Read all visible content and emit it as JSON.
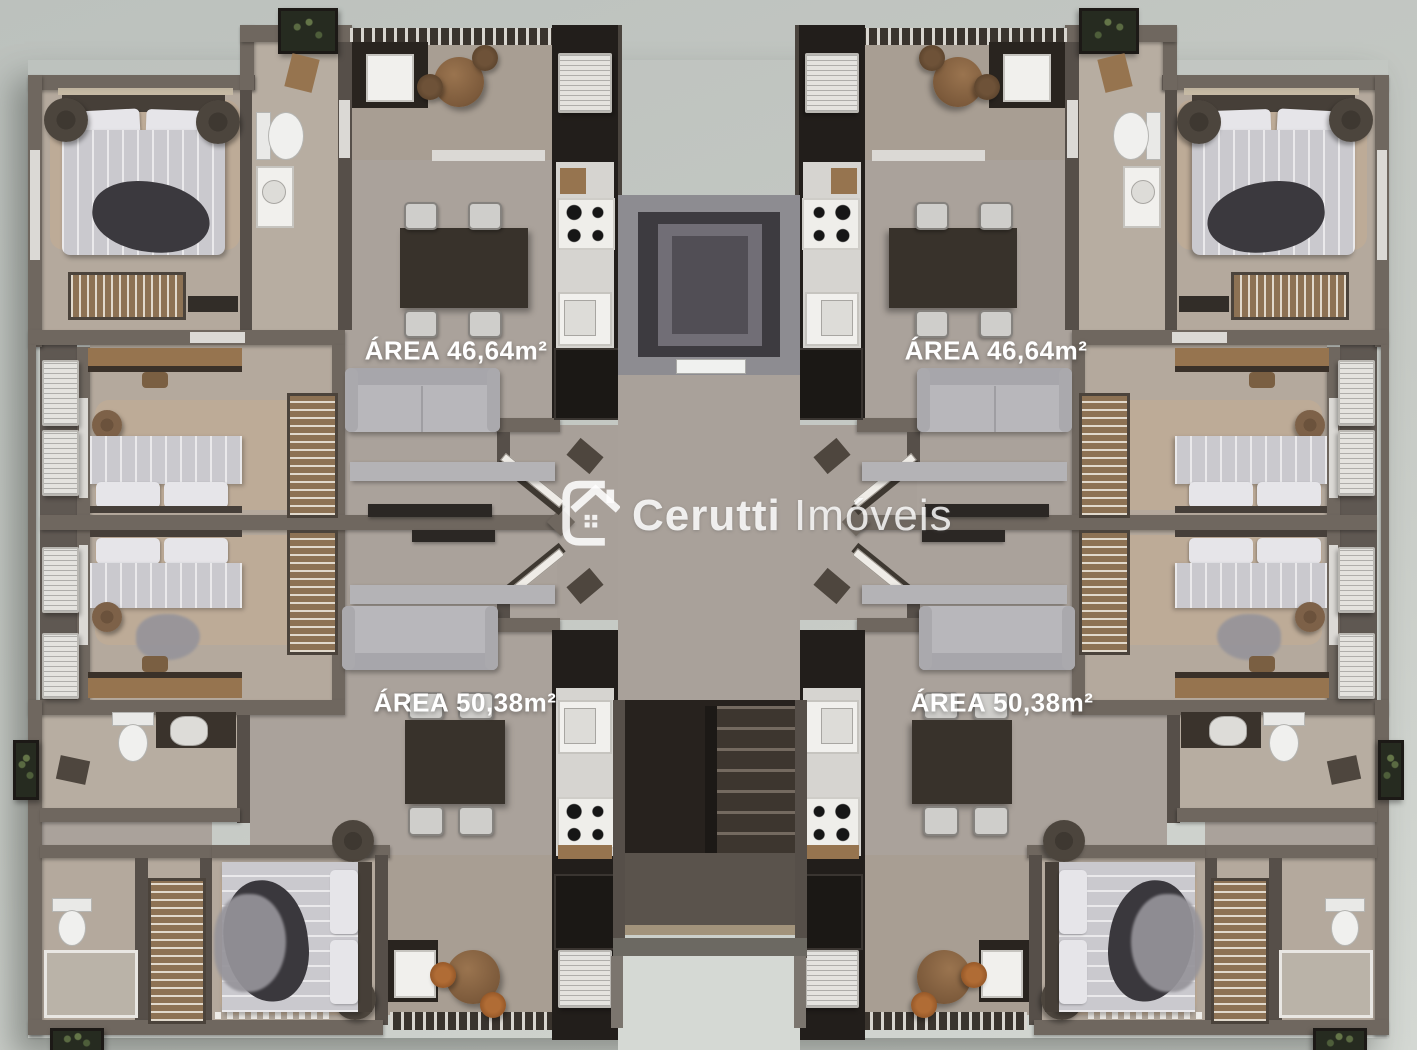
{
  "units": {
    "top_left": {
      "area_label": "ÁREA 46,64m²"
    },
    "top_right": {
      "area_label": "ÁREA 46,64m²"
    },
    "bottom_left": {
      "area_label": "ÁREA 50,38m²"
    },
    "bottom_right": {
      "area_label": "ÁREA 50,38m²"
    }
  },
  "watermark": {
    "brand": "Cerutti",
    "suffix": "Imóveis",
    "logo_icon": "house-in-c-logo"
  },
  "palette": {
    "background": "#c6cac5",
    "wall": "#6f675f",
    "wall_dark": "#564f49",
    "floor": "#a9a19a",
    "floor_bedroom": "#b4a99d",
    "floor_balcony": "#a89e93",
    "cabinet_dark": "#221e1b",
    "stair_void": "#27221e",
    "elevator_shaft": "#3d3b40",
    "label_text": "#ffffff",
    "watermark_text": "rgba(255,255,255,0.86)"
  }
}
